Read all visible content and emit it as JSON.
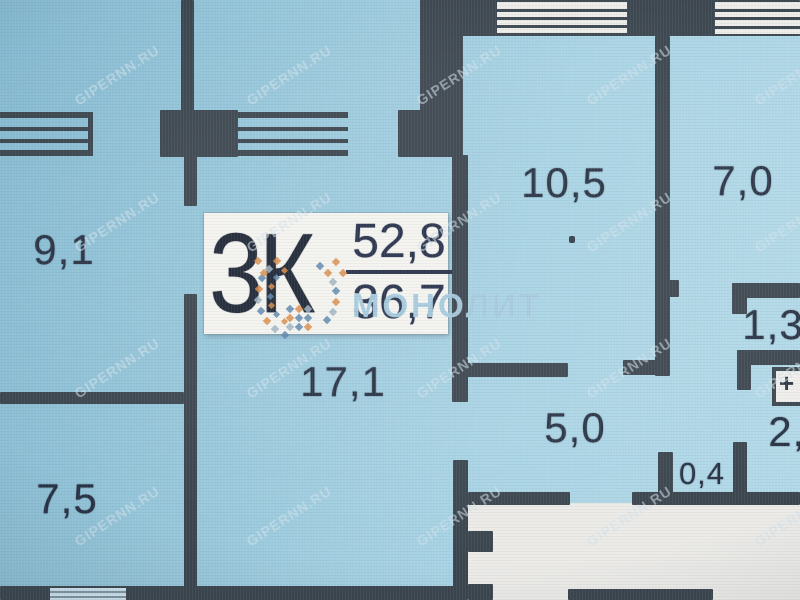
{
  "plan": {
    "unit_label": "3К",
    "area_total": "52,8",
    "area_living": "36,7",
    "panel_symbol": "+",
    "rooms": [
      {
        "area": "9,1"
      },
      {
        "area": "17,1"
      },
      {
        "area": "7,5"
      },
      {
        "area": "10,5"
      },
      {
        "area": "7,0"
      },
      {
        "area": "5,0"
      },
      {
        "area": "0,4"
      },
      {
        "area": "1,3"
      },
      {
        "area": "2,4"
      }
    ]
  },
  "watermarks": {
    "site": "GIPERNN.RU",
    "developer": "МОНОЛИТ"
  },
  "colors": {
    "room_fill": "#9ccadd",
    "wall": "#3b454e",
    "outside": "#ecebe8",
    "window_white": "#edece8",
    "label_text": "#273143",
    "box_bg": "#f4f3ef",
    "watermark": "#d3e3ec",
    "logo_orange": "#d98a45",
    "logo_blue": "#5b85ad"
  }
}
